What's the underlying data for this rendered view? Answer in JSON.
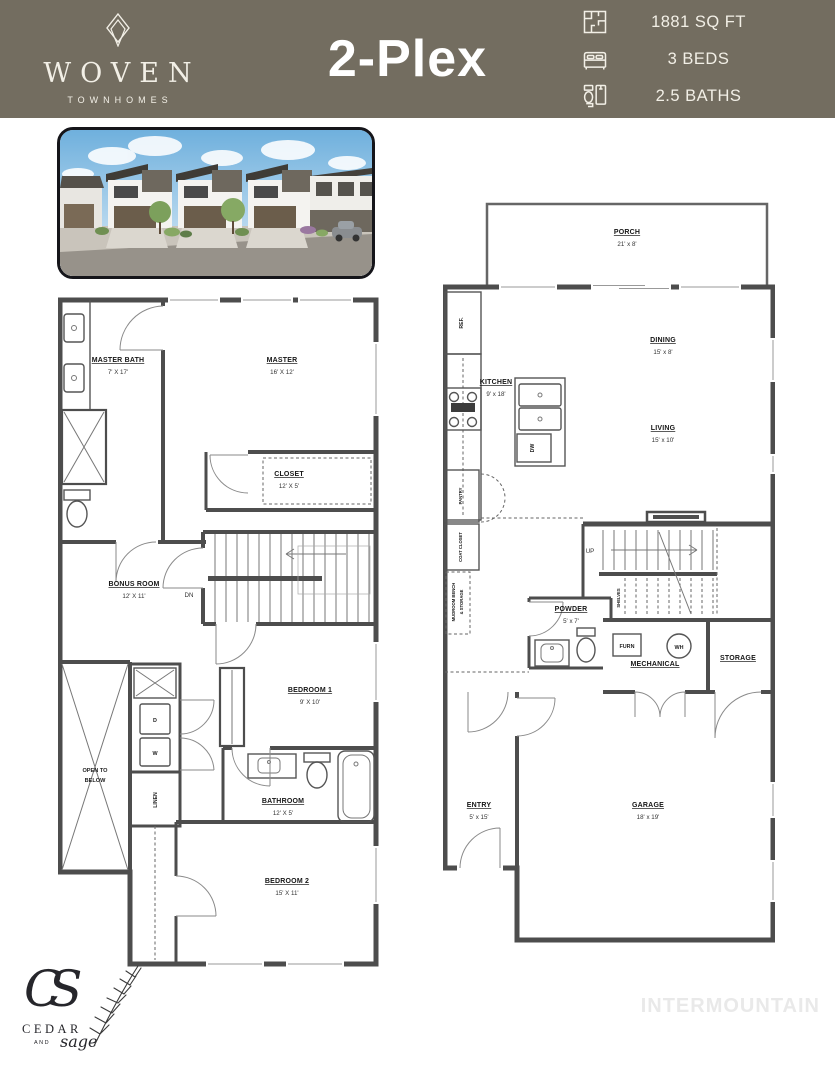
{
  "header": {
    "colors": {
      "background": "#736d60",
      "text": "#f2efe6"
    },
    "brand": {
      "name": "WOVEN",
      "tagline": "TOWNHOMES",
      "logo_icon": "double-diamond-icon"
    },
    "title": "2-Plex",
    "specs": [
      {
        "icon": "floorplan-icon",
        "label": "1881 SQ FT"
      },
      {
        "icon": "bed-icon",
        "label": "3 BEDS"
      },
      {
        "icon": "bath-icon",
        "label": "2.5 BATHS"
      }
    ]
  },
  "plans": {
    "upper": {
      "master_bath": {
        "name": "MASTER BATH",
        "dims": "7' X 17'"
      },
      "master": {
        "name": "MASTER",
        "dims": "16' X 12'"
      },
      "closet": {
        "name": "CLOSET",
        "dims": "12' X 5'"
      },
      "bonus": {
        "name": "BONUS ROOM",
        "dims": "12' X 11'"
      },
      "bedroom1": {
        "name": "BEDROOM 1",
        "dims": "9' X 10'"
      },
      "bathroom": {
        "name": "BATHROOM",
        "dims": "12' X 5'"
      },
      "bedroom2": {
        "name": "BEDROOM 2",
        "dims": "15' X 11'"
      },
      "open_below_line1": "OPEN TO",
      "open_below_line2": "BELOW",
      "dn": "DN",
      "linen": "LINEN",
      "dryer": "D",
      "washer": "W"
    },
    "main": {
      "porch": {
        "name": "PORCH",
        "dims": "21' x 8'"
      },
      "dining": {
        "name": "DINING",
        "dims": "15' x 8'"
      },
      "kitchen": {
        "name": "KITCHEN",
        "dims": "9' x 18'"
      },
      "living": {
        "name": "LIVING",
        "dims": "15' x 10'"
      },
      "powder": {
        "name": "POWDER",
        "dims": "5' x 7'"
      },
      "mechanical": {
        "name": "MECHANICAL"
      },
      "storage": {
        "name": "STORAGE"
      },
      "entry": {
        "name": "ENTRY",
        "dims": "5' x 15'"
      },
      "garage": {
        "name": "GARAGE",
        "dims": "18' x 19'"
      },
      "ref": "REF.",
      "pantry": "PANTRY",
      "coat_closet": "COAT CLOSET",
      "mudroom_line1": "MUDROOM BENCH",
      "mudroom_line2": "& STORAGE",
      "shelves": "SHELVES",
      "up": "UP",
      "dw": "DW",
      "furn": "FURN",
      "wh": "WH"
    }
  },
  "footer": {
    "builder_logo": {
      "initials": "CS",
      "line1": "CEDAR",
      "line2": "AND",
      "line3": "sage"
    },
    "watermark": "INTERMOUNTAIN"
  }
}
